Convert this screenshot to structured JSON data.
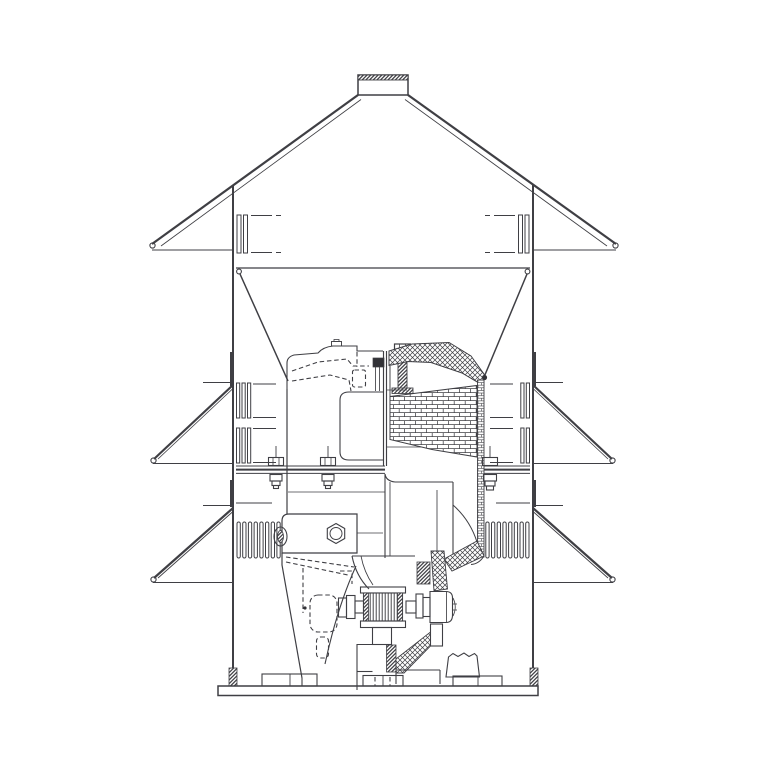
{
  "window": {
    "width": 768,
    "height": 768,
    "background": "#ffffff"
  },
  "figure": {
    "type": "technical-cross-section-diagram",
    "subject": "Sectional engineering drawing of a vertical roof ventilator (axial fan unit)",
    "visible_text": [],
    "colors": {
      "line": "#3f3f44",
      "dark_fill": "#323237",
      "background": "#ffffff"
    },
    "components": [
      "exhaust-cap",
      "weather-hood-roof",
      "storm-collar-top",
      "storm-collar-middle",
      "storm-collar-bottom",
      "casing-wall-left",
      "casing-wall-right",
      "louvre-slots-top",
      "louvre-slots-middle",
      "louvre-slots-bottom",
      "inlet-funnel",
      "impeller-shroud-section",
      "impeller-body-section",
      "fan-scroll-outline",
      "hub-bolt",
      "mounting-flange",
      "flange-bolts",
      "motor-support-frame",
      "anti-vibration-mount",
      "drive-motor",
      "motor-shaft",
      "bearing-hub",
      "support-bracket-plate",
      "support-leg",
      "pedestal",
      "drain-spout",
      "base-frame",
      "foundation-feet"
    ]
  }
}
